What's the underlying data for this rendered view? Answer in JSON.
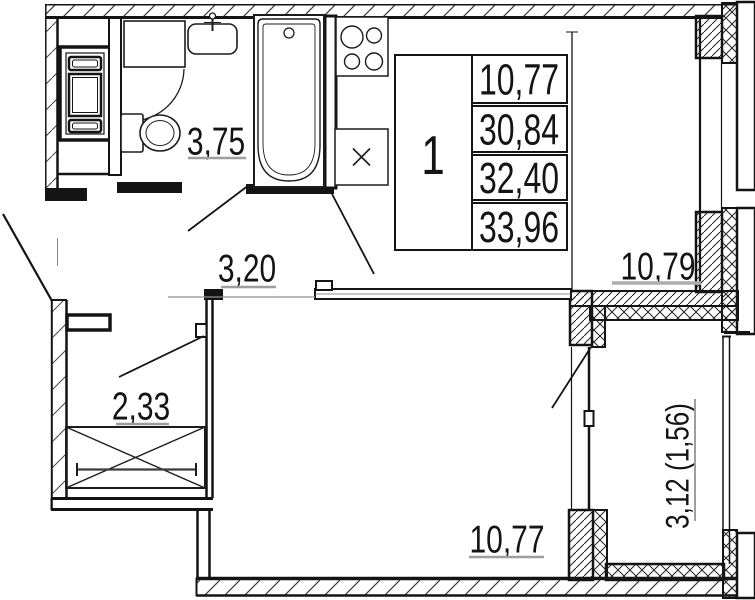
{
  "unit_table": {
    "unit_number": "1",
    "areas": [
      "10,77",
      "30,84",
      "32,40",
      "33,96"
    ]
  },
  "room_labels": {
    "bathroom": "3,75",
    "hall": "3,20",
    "kitchen_living": "10,79",
    "entry_hall": "2,33",
    "room": "10,77",
    "balcony": "3,12 (1,56)"
  },
  "colors": {
    "line": "#141414",
    "underline": "#9e9e9e",
    "background": "#ffffff"
  }
}
